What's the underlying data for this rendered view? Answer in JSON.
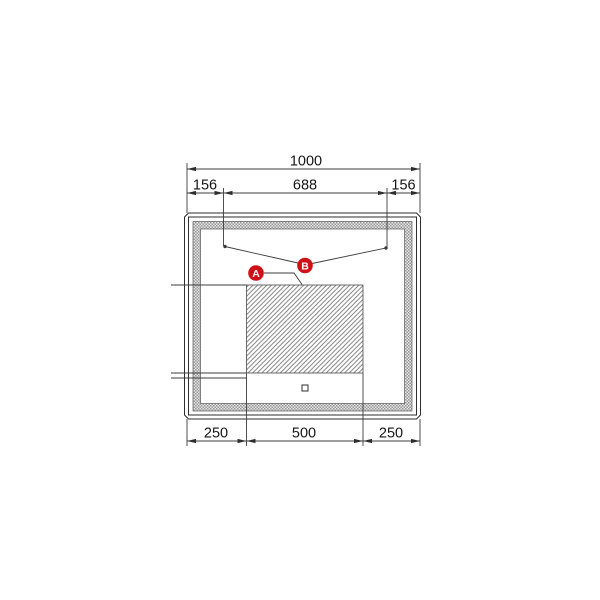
{
  "diagram": {
    "dimensions_top": {
      "total": "1000",
      "left": "156",
      "center": "688",
      "right": "156"
    },
    "dimensions_bottom": {
      "left": "250",
      "center": "500",
      "right": "250"
    },
    "callouts": {
      "a": "A",
      "b": "B"
    },
    "colors": {
      "callout": "#ce1117",
      "line": "#3c3c3c"
    }
  }
}
